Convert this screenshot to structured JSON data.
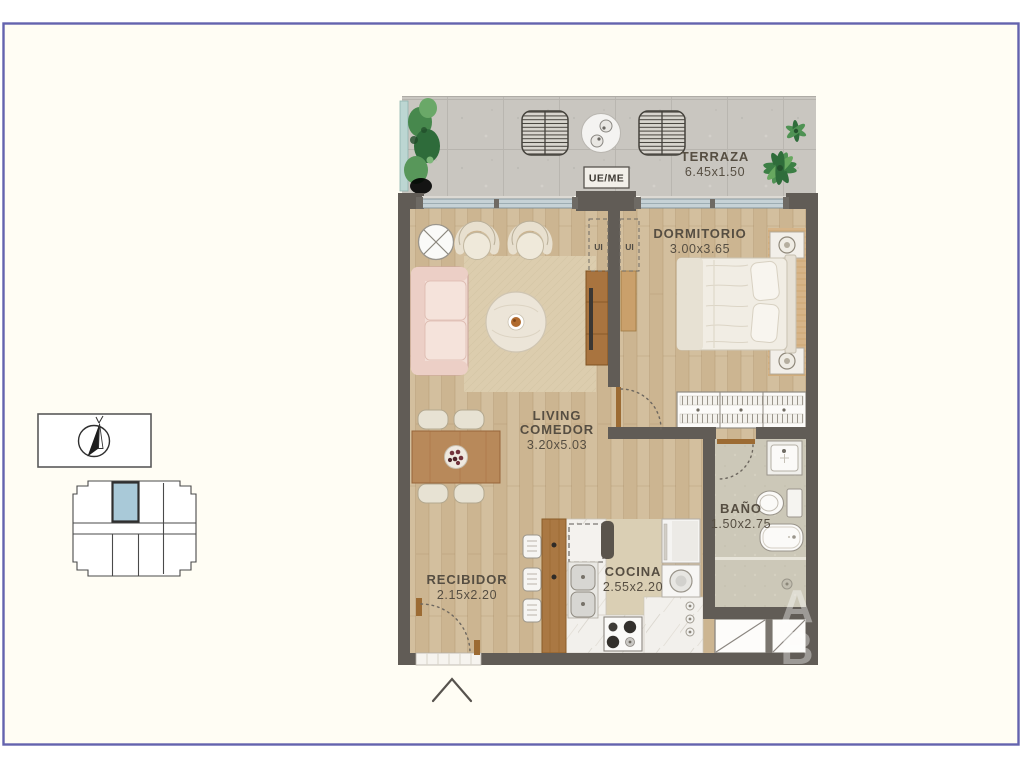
{
  "page": {
    "background": "#ffffff",
    "frame_color": "#6463ae",
    "canvas_color": "#fffdf4"
  },
  "floor_plan": {
    "rooms": {
      "terraza": {
        "name": "TERRAZA",
        "dims": "6.45x1.50"
      },
      "dormitorio": {
        "name": "DORMITORIO",
        "dims": "3.00x3.65"
      },
      "living_comedor": {
        "name_line1": "LIVING",
        "name_line2": "COMEDOR",
        "dims": "3.20x5.03"
      },
      "bano": {
        "name": "BAÑO",
        "dims": "1.50x2.75"
      },
      "cocina": {
        "name": "COCINA",
        "dims": "2.55x2.20"
      },
      "recibidor": {
        "name": "RECIBIDOR",
        "dims": "2.15x2.20"
      }
    },
    "annotations": {
      "meter_box": "UE/ME",
      "closet_left": "UI",
      "closet_right": "UI"
    },
    "watermark": {
      "letter1": "A",
      "letter2": "B"
    },
    "colors": {
      "wall": "#615c56",
      "wood_floor": "#d3bf9e",
      "terrace_floor": "#c9c6c0",
      "bath_floor": "#ccc8b8",
      "rug": "#dccdae",
      "glass": "#c6d2d6",
      "sofa": "#f2ded6",
      "label_text": "#564e42",
      "door_wood": "#9c6b33"
    }
  },
  "key_plan": {
    "highlight_color": "#a9c9d8",
    "outline_color": "#4a4a4a"
  }
}
